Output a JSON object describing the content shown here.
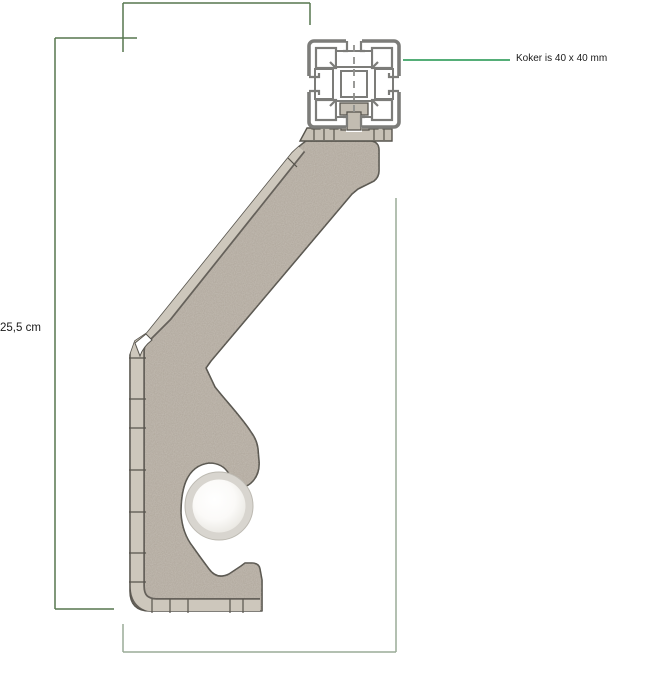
{
  "canvas": {
    "width": 657,
    "height": 700,
    "background": "#ffffff"
  },
  "labels": {
    "koker_note": "Koker is 40 x 40 mm",
    "height_dimension": "25,5 cm"
  },
  "colors": {
    "bracket_fill": "#b3aba0",
    "bracket_flange": "#cdc7bc",
    "bracket_outline": "#57544d",
    "plate_fill": "#c7c1b6",
    "koker_gray": "#7c7c79",
    "dimension_green_dark": "#57774f",
    "dimension_green_light": "#9aab97",
    "annotation_green": "#3da364",
    "hole_ring": "#d8d5cf",
    "text_color": "#1a1a1a"
  },
  "parts": [
    "40x40-box-profile-cross-section",
    "corner-bracket",
    "mounting-tab",
    "serrated-mounting-plate",
    "tube-hole",
    "hook-foot",
    "height-dimension-line",
    "width-dimension-lines",
    "koker-annotation-line"
  ]
}
